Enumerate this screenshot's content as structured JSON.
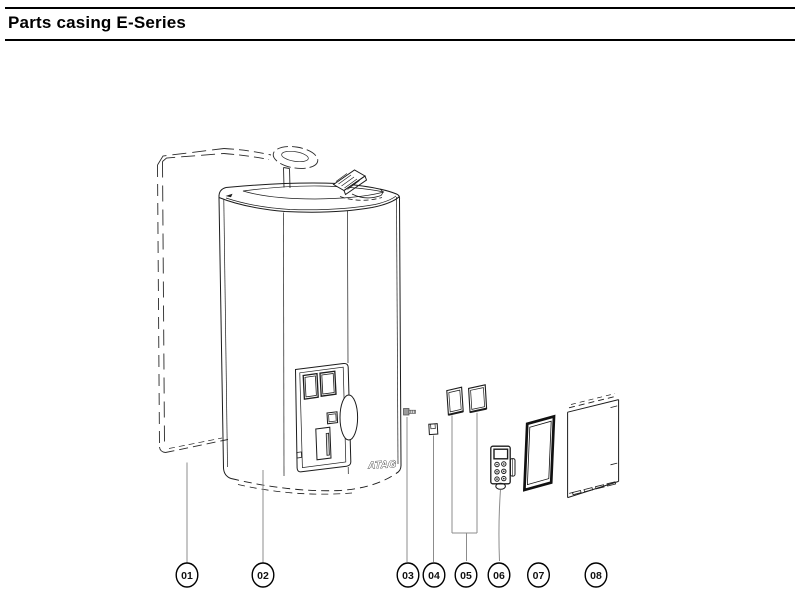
{
  "page": {
    "title": "Parts casing E-Series",
    "background_color": "#ffffff",
    "line_color": "#1c1c1c",
    "leader_line_color": "#8c8c8c"
  },
  "diagram": {
    "brand": "ATAG",
    "callouts": [
      {
        "label": "01"
      },
      {
        "label": "02"
      },
      {
        "label": "03"
      },
      {
        "label": "04"
      },
      {
        "label": "05"
      },
      {
        "label": "06"
      },
      {
        "label": "07"
      },
      {
        "label": "08"
      }
    ]
  }
}
